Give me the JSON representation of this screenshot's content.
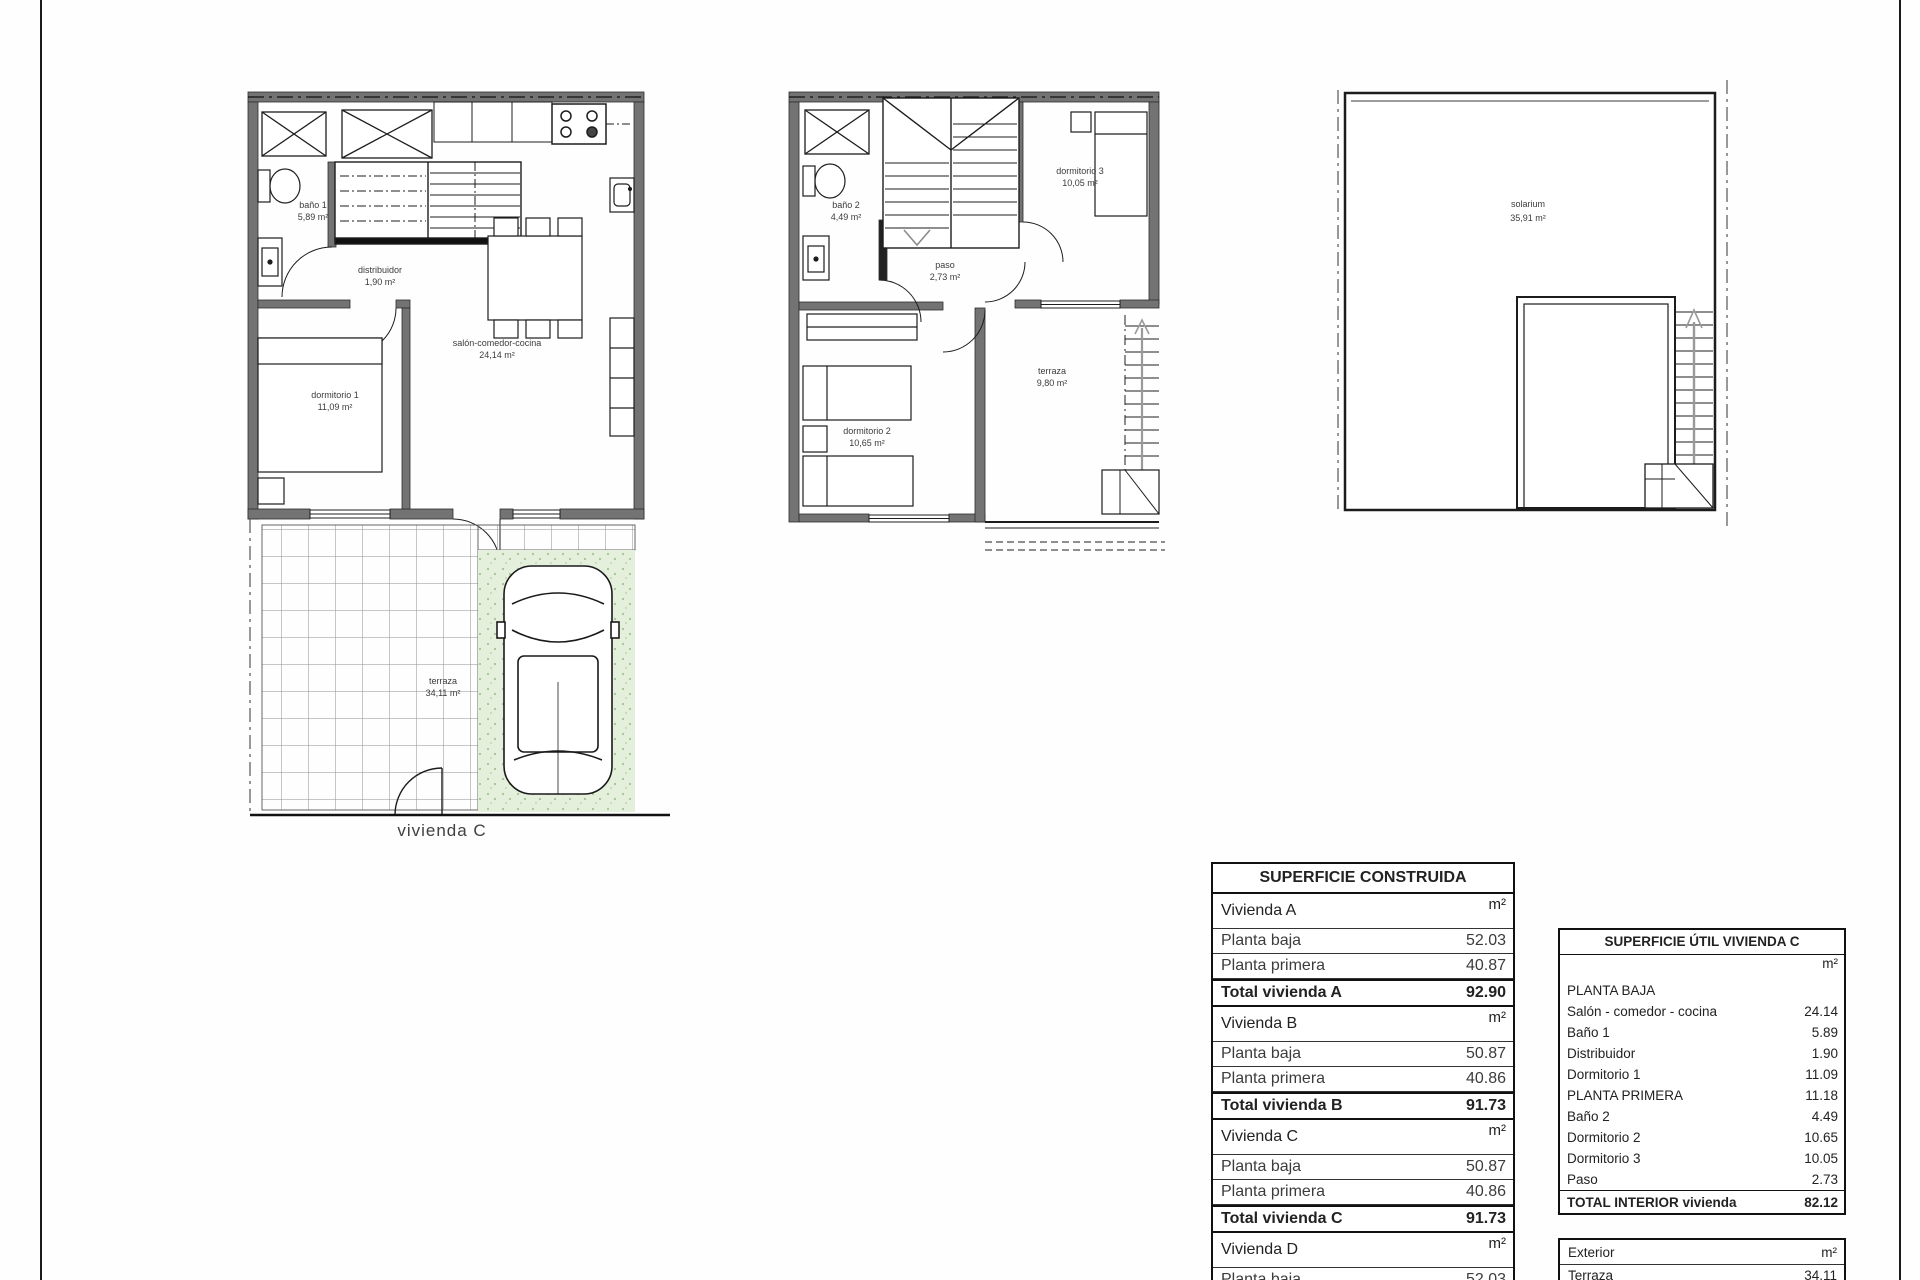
{
  "colors": {
    "wall": "#737373",
    "garden_fill": "#e4efdc",
    "garden_dots": "#a3c395",
    "line": "#1a1a1a"
  },
  "plans": {
    "ground_floor": {
      "caption": "vivienda C",
      "rooms": {
        "bano1": {
          "name": "baño 1",
          "area": "5,89 m²"
        },
        "distribuidor": {
          "name": "distribuidor",
          "area": "1,90 m²"
        },
        "salon": {
          "name": "salón-comedor-cocina",
          "area": "24,14 m²"
        },
        "dormitorio1": {
          "name": "dormitorio 1",
          "area": "11,09 m²"
        },
        "terraza": {
          "name": "terraza",
          "area": "34,11 m²"
        }
      }
    },
    "first_floor": {
      "rooms": {
        "bano2": {
          "name": "baño 2",
          "area": "4,49 m²"
        },
        "paso": {
          "name": "paso",
          "area": "2,73 m²"
        },
        "dormitorio3": {
          "name": "dormitorio 3",
          "area": "10,05 m²"
        },
        "dormitorio2": {
          "name": "dormitorio 2",
          "area": "10,65 m²"
        },
        "terraza": {
          "name": "terraza",
          "area": "9,80 m²"
        }
      }
    },
    "solarium": {
      "rooms": {
        "solarium": {
          "name": "solarium",
          "area": "35,91 m²"
        }
      }
    }
  },
  "tables": {
    "construida": {
      "title": "SUPERFICIE CONSTRUIDA",
      "rows": [
        {
          "label": "Vivienda A",
          "value": "m²"
        },
        {
          "label": "Planta baja",
          "value": "52.03"
        },
        {
          "label": "Planta primera",
          "value": "40.87"
        },
        {
          "label": "Total vivienda A",
          "value": "92.90"
        },
        {
          "label": "Vivienda B",
          "value": "m²"
        },
        {
          "label": "Planta baja",
          "value": "50.87"
        },
        {
          "label": "Planta primera",
          "value": "40.86"
        },
        {
          "label": "Total vivienda B",
          "value": "91.73"
        },
        {
          "label": "Vivienda C",
          "value": "m²"
        },
        {
          "label": "Planta baja",
          "value": "50.87"
        },
        {
          "label": "Planta primera",
          "value": "40.86"
        },
        {
          "label": "Total vivienda C",
          "value": "91.73"
        },
        {
          "label": "Vivienda D",
          "value": "m²"
        },
        {
          "label": "Planta baja",
          "value": "52.03"
        }
      ]
    },
    "util": {
      "title": "SUPERFICIE ÚTIL VIVIENDA C",
      "rows": [
        {
          "label": "",
          "value": "m²"
        },
        {
          "label": "PLANTA BAJA",
          "value": ""
        },
        {
          "label": "Salón - comedor - cocina",
          "value": "24.14"
        },
        {
          "label": "Baño 1",
          "value": "5.89"
        },
        {
          "label": "Distribuidor",
          "value": "1.90"
        },
        {
          "label": "Dormitorio 1",
          "value": "11.09"
        },
        {
          "label": "PLANTA PRIMERA",
          "value": "11.18"
        },
        {
          "label": "Baño 2",
          "value": "4.49"
        },
        {
          "label": "Dormitorio 2",
          "value": "10.65"
        },
        {
          "label": "Dormitorio 3",
          "value": "10.05"
        },
        {
          "label": "Paso",
          "value": "2.73"
        },
        {
          "label": "TOTAL INTERIOR vivienda",
          "value": "82.12"
        },
        {
          "label": "Exterior",
          "value": "m²"
        },
        {
          "label": "Terraza",
          "value": "34.11"
        }
      ]
    }
  }
}
